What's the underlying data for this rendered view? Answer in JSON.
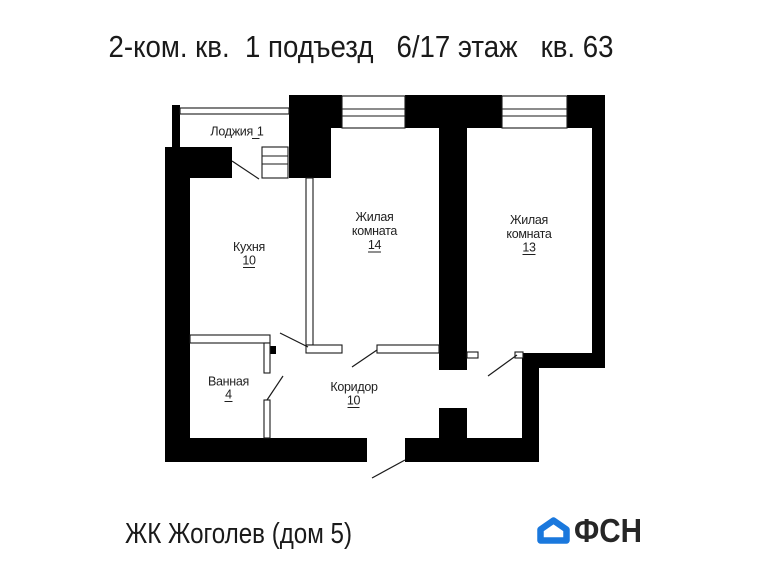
{
  "title": "2-ком. кв.  1 подъезд   6/17 этаж   кв. 63",
  "plan": {
    "rooms": {
      "loggia": {
        "name": "Лоджия",
        "area": "1"
      },
      "kitchen": {
        "name": "Кухня",
        "area": "10"
      },
      "living1": {
        "name_line1": "Жилая",
        "name_line2": "комната",
        "area": "14"
      },
      "living2": {
        "name_line1": "Жилая",
        "name_line2": "комната",
        "area": "13"
      },
      "bathroom": {
        "name": "Ванная",
        "area": "4"
      },
      "corridor": {
        "name": "Коридор",
        "area": "10"
      }
    },
    "wall_color": "#000000"
  },
  "footer": {
    "project": "ЖК Жоголев (дом 5)",
    "logo_text": "ФСН",
    "logo_color": "#1a78dd",
    "logo_text_color": "#262626"
  }
}
